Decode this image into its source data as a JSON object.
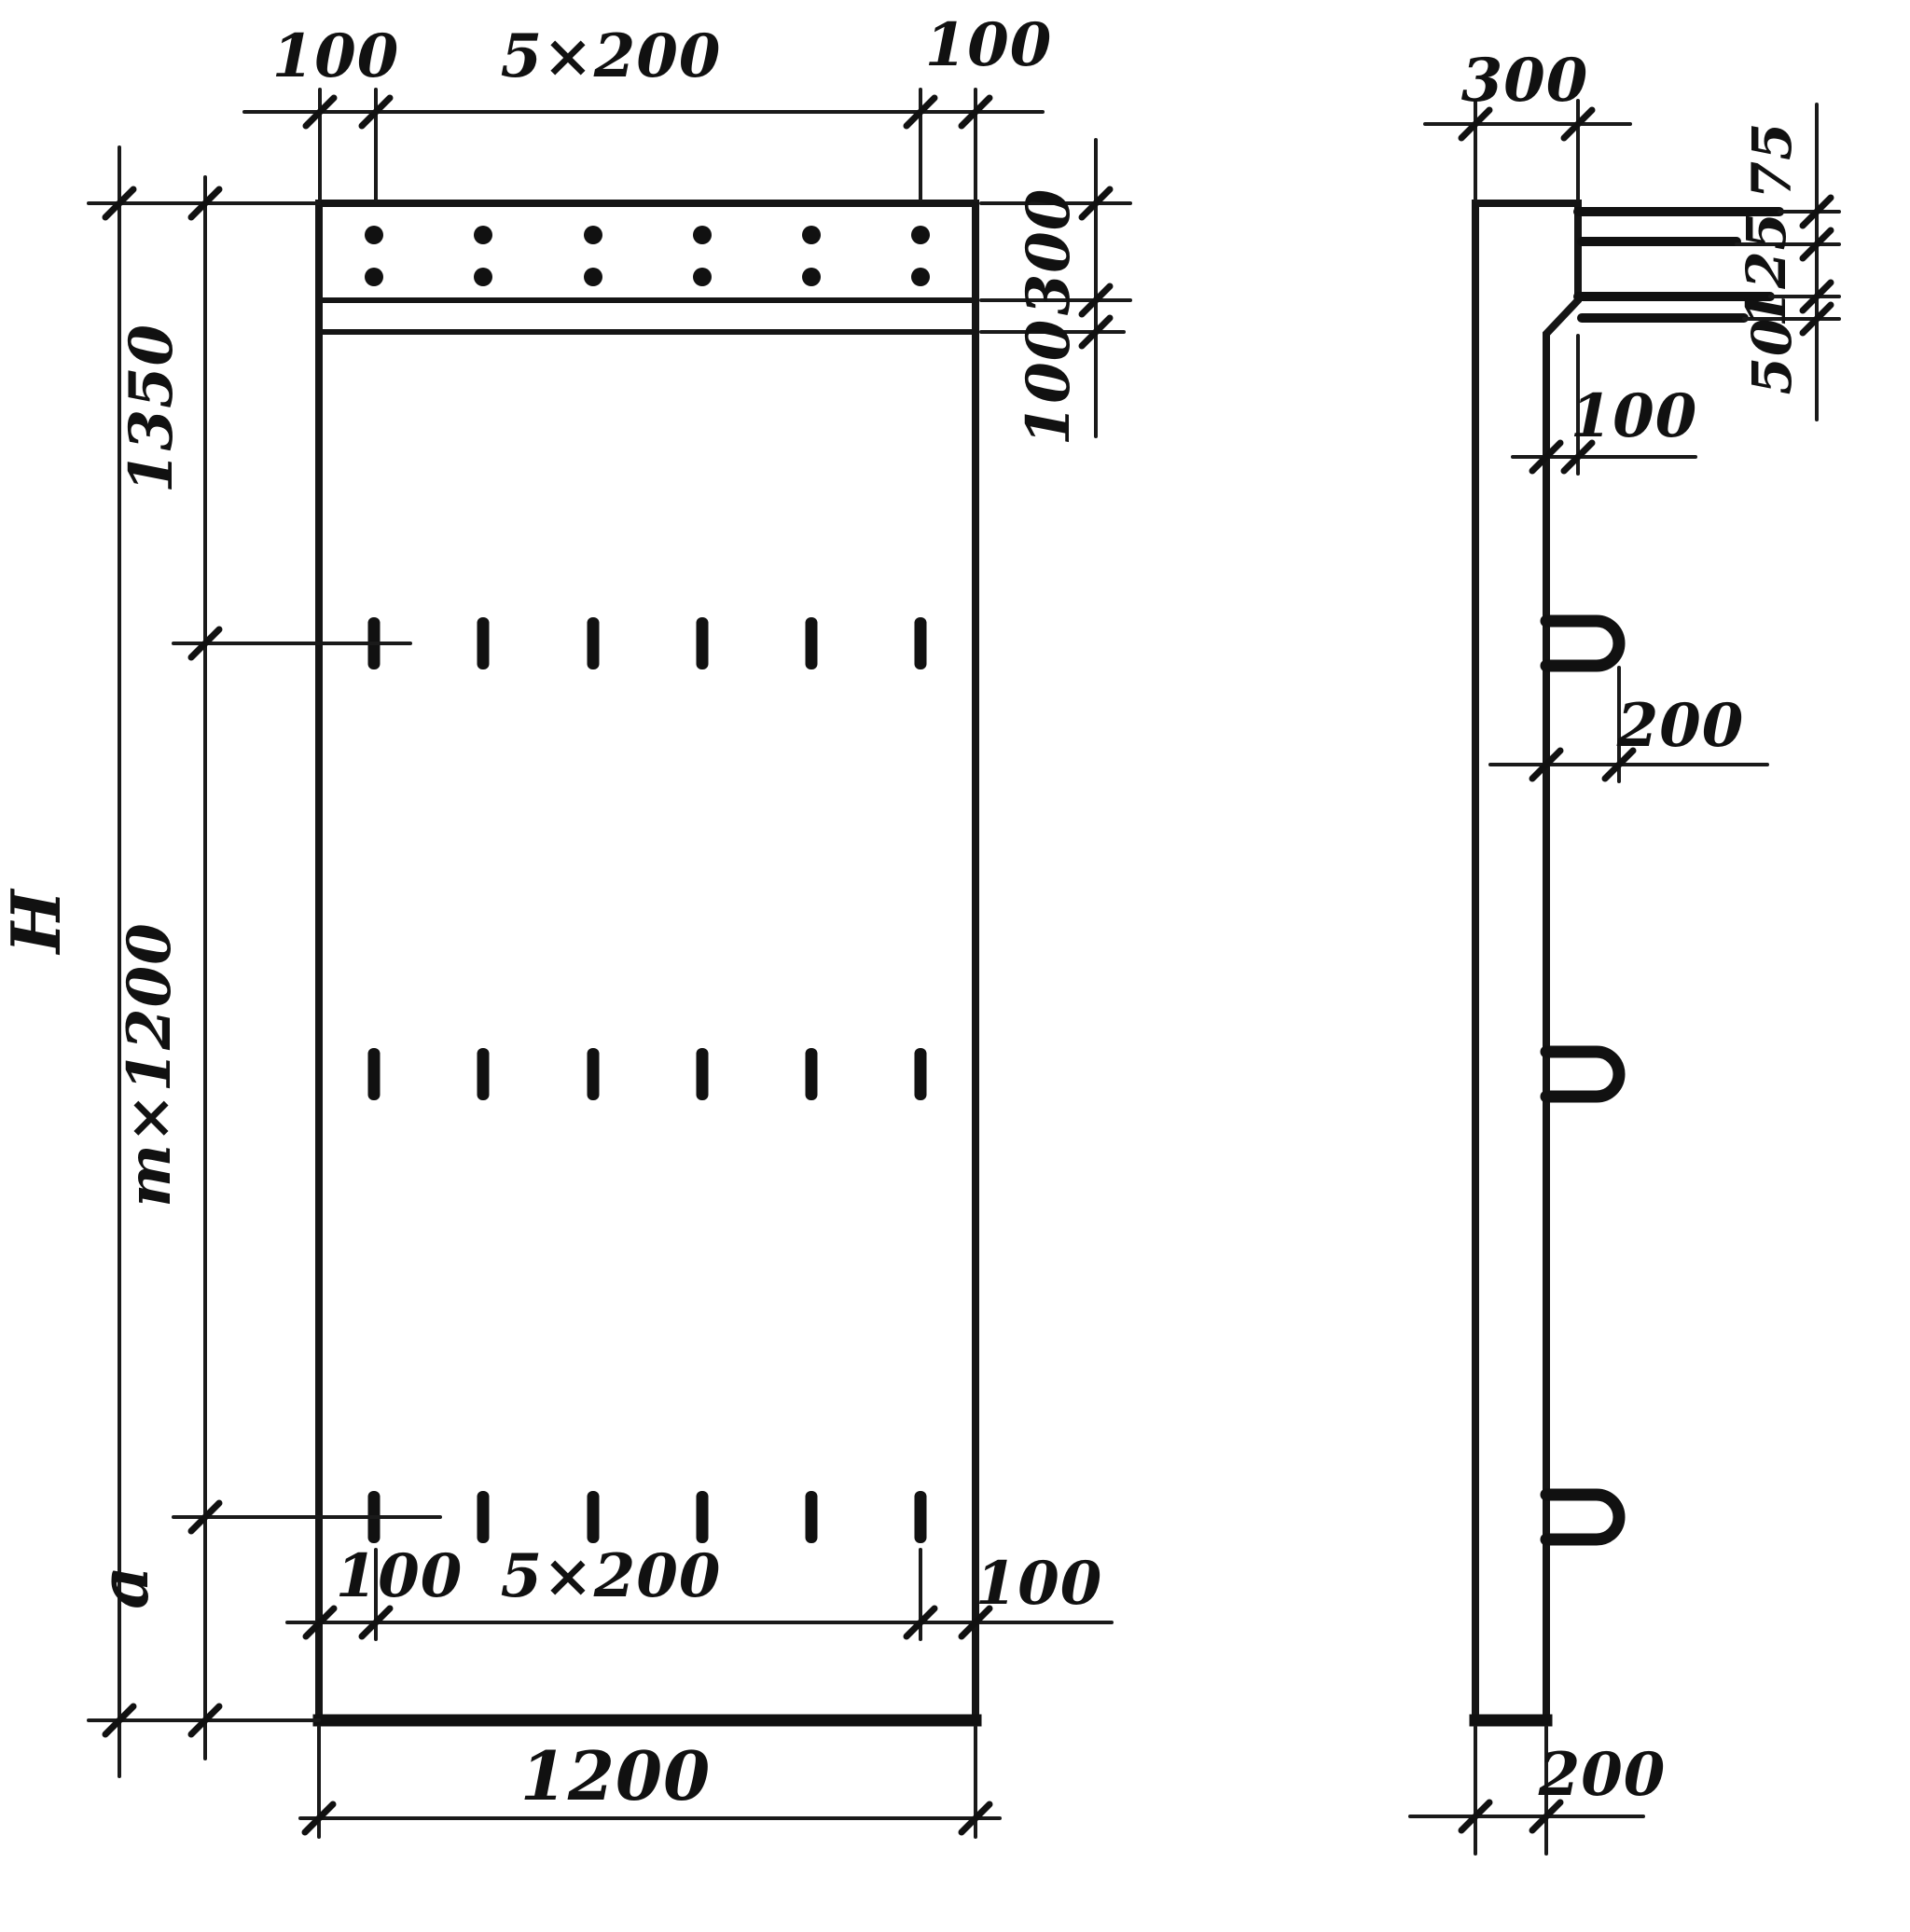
{
  "drawing": {
    "kind": "reinforced concrete panel – dimensioned drawing",
    "views": {
      "front": {
        "top": {
          "left_offset": "100",
          "spacing": "5×200",
          "right_offset": "100"
        },
        "right": {
          "strip_height": "300",
          "gap": "100"
        },
        "left": {
          "total_height": "H",
          "top_segment": "1350",
          "middle_segment": "m×1200",
          "bottom_segment": "a"
        },
        "bottom": {
          "left_offset": "100",
          "spacing": "5×200",
          "right_offset": "100",
          "width": "1200"
        }
      },
      "side": {
        "top": {
          "thickness": "300"
        },
        "right": {
          "top": "75",
          "middle": "125",
          "bottom": "50"
        },
        "ledge": {
          "offset": "100"
        },
        "loop": {
          "offset": "200"
        },
        "bottom": {
          "thickness": "200"
        }
      }
    }
  }
}
